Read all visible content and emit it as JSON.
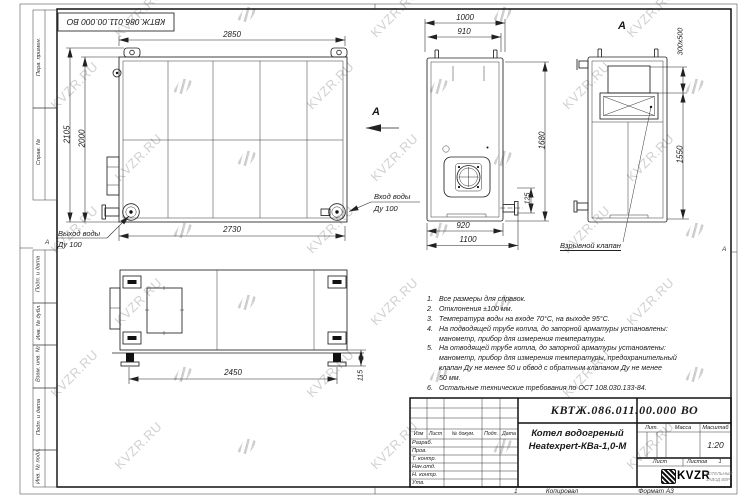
{
  "watermark": {
    "text": "KVZR.RU",
    "color": "#c9c9c9"
  },
  "sheet": {
    "stamp_top": "КВТЖ.086.011.00.000 ВО",
    "zone_left": "А",
    "zone_right": "А",
    "zone_bottom_num": "1",
    "footer": {
      "kopiroval": "Копировал",
      "format": "Формат А3"
    },
    "margin_labels": [
      "Перв. примен.",
      "Справ. №",
      "Подп. и дата",
      "Инв. № дубл.",
      "Взам. инв. №",
      "Подп. и дата",
      "Инв. № подл."
    ]
  },
  "views": {
    "front": {
      "dim_top": "2850",
      "dim_left_outer": "2105",
      "dim_left_inner": "2000",
      "dim_bottom": "2730",
      "outlet_label1": "Выход воды",
      "outlet_label2": "Ду 100",
      "inlet_label1": "Вход воды",
      "inlet_label2": "Ду 100",
      "view_arrow_label": "А"
    },
    "side": {
      "dim_top_outer": "1000",
      "dim_top_inner": "910",
      "dim_right": "1680",
      "dim_pipe": "125",
      "dim_bottom_inner": "920",
      "dim_bottom_outer": "1100"
    },
    "section": {
      "label": "А",
      "dim_valve": "300х500",
      "dim_height": "1550",
      "callout": "Взрывной клапан"
    },
    "plan": {
      "dim_width": "2450",
      "dim_foot": "115"
    }
  },
  "notes": {
    "lines": [
      {
        "num": "1.",
        "text": "Все размеры для справок."
      },
      {
        "num": "2.",
        "text": "Отклонения ±100 мм."
      },
      {
        "num": "3.",
        "text": "Температура воды на входе 70°С, на выходе 95°С."
      },
      {
        "num": "4.",
        "text": "На подводящей трубе котла, до запорной арматуры установлены:"
      },
      {
        "num": "",
        "text": "манометр, прибор для измерения температуры."
      },
      {
        "num": "5.",
        "text": "На отводящей трубе котла, до запорной арматуры установлены:"
      },
      {
        "num": "",
        "text": "манометр, прибор для измерения температуры, предохранительный"
      },
      {
        "num": "",
        "text": "клапан Ду не менее 50 и обвод с обратным клапаном Ду не менее"
      },
      {
        "num": "",
        "text": "50 мм."
      },
      {
        "num": "6.",
        "text": "Остальные технические требования по ОСТ 108.030.133-84."
      }
    ]
  },
  "title_block": {
    "designation": "КВТЖ.086.011.00.000 ВО",
    "name_line1": "Котел водогреный",
    "name_line2": "Heatexpert-КВа-1,0-М",
    "col_izm": "Изм",
    "col_list": "Лист",
    "col_doc": "№ докум.",
    "col_podp": "Подп.",
    "col_data": "Дата",
    "row_labels": [
      "Разраб.",
      "Пров.",
      "Т. контр.",
      "Нач.отд.",
      "Н. контр.",
      "Утв."
    ],
    "lit_label": "Лит.",
    "mass_label": "Масса",
    "scale_label": "Масштаб",
    "scale_value": "1:20",
    "sheet_label": "Лист",
    "sheets_label": "Листов",
    "sheets_value": "1",
    "logo_text": "KVZR",
    "logo_tagline1": "КОТЕЛЬНЫЙ",
    "logo_tagline2": "ЗАВОД ВВР"
  }
}
